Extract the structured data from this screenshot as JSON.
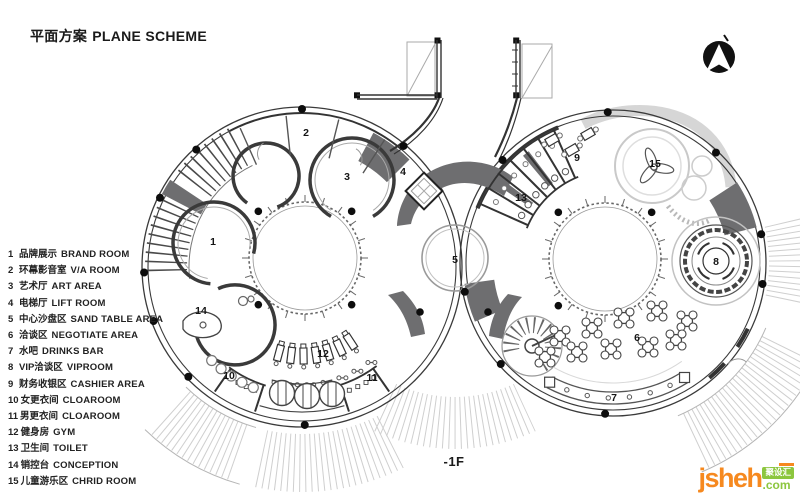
{
  "header": {
    "title_zh": "平面方案",
    "title_en": "PLANE SCHEME"
  },
  "legend": {
    "items": [
      {
        "num": "1",
        "zh": "品牌展示",
        "en": "BRAND ROOM"
      },
      {
        "num": "2",
        "zh": "环幕影音室",
        "en": "V/A ROOM"
      },
      {
        "num": "3",
        "zh": "艺术厅",
        "en": "ART AREA"
      },
      {
        "num": "4",
        "zh": "电梯厅",
        "en": "LIFT ROOM"
      },
      {
        "num": "5",
        "zh": "中心沙盘区",
        "en": "SAND TABLE AREA"
      },
      {
        "num": "6",
        "zh": "洽谈区",
        "en": "NEGOTIATE AREA"
      },
      {
        "num": "7",
        "zh": "水吧",
        "en": "DRINKS BAR"
      },
      {
        "num": "8",
        "zh": "VIP洽谈区",
        "en": "VIPROOM"
      },
      {
        "num": "9",
        "zh": "财务收银区",
        "en": "CASHIER AREA"
      },
      {
        "num": "10",
        "zh": "女更衣间",
        "en": "CLOAROOM"
      },
      {
        "num": "11",
        "zh": "男更衣间",
        "en": "CLOAROOM"
      },
      {
        "num": "12",
        "zh": "健身房",
        "en": "GYM"
      },
      {
        "num": "13",
        "zh": "卫生间",
        "en": "TOILET"
      },
      {
        "num": "14",
        "zh": "销控台",
        "en": "CONCEPTION"
      },
      {
        "num": "15",
        "zh": "儿童游乐区",
        "en": "CHRID ROOM"
      }
    ]
  },
  "floor_label": "-1F",
  "watermark": {
    "brand": "jsheh",
    "tld": ".com",
    "cn": "聚设汇"
  },
  "plan": {
    "labels": [
      {
        "n": "1",
        "x": 213,
        "y": 245
      },
      {
        "n": "2",
        "x": 306,
        "y": 136
      },
      {
        "n": "3",
        "x": 347,
        "y": 180
      },
      {
        "n": "4",
        "x": 403,
        "y": 175
      },
      {
        "n": "5",
        "x": 455,
        "y": 263
      },
      {
        "n": "6",
        "x": 637,
        "y": 341
      },
      {
        "n": "7",
        "x": 614,
        "y": 401
      },
      {
        "n": "8",
        "x": 716,
        "y": 265
      },
      {
        "n": "9",
        "x": 577,
        "y": 161
      },
      {
        "n": "10",
        "x": 229,
        "y": 379
      },
      {
        "n": "11",
        "x": 372,
        "y": 381
      },
      {
        "n": "12",
        "x": 323,
        "y": 357
      },
      {
        "n": "13",
        "x": 521,
        "y": 201
      },
      {
        "n": "14",
        "x": 201,
        "y": 314
      },
      {
        "n": "15",
        "x": 655,
        "y": 167
      }
    ],
    "colors": {
      "wall": "#333333",
      "thin": "#999999",
      "poche": "#6e6e70",
      "hatch": "#cfcfcf",
      "light": "#d6d6d6",
      "dot": "#0d0d0d",
      "orange": "#f6891f",
      "green": "#8cc63e"
    }
  }
}
